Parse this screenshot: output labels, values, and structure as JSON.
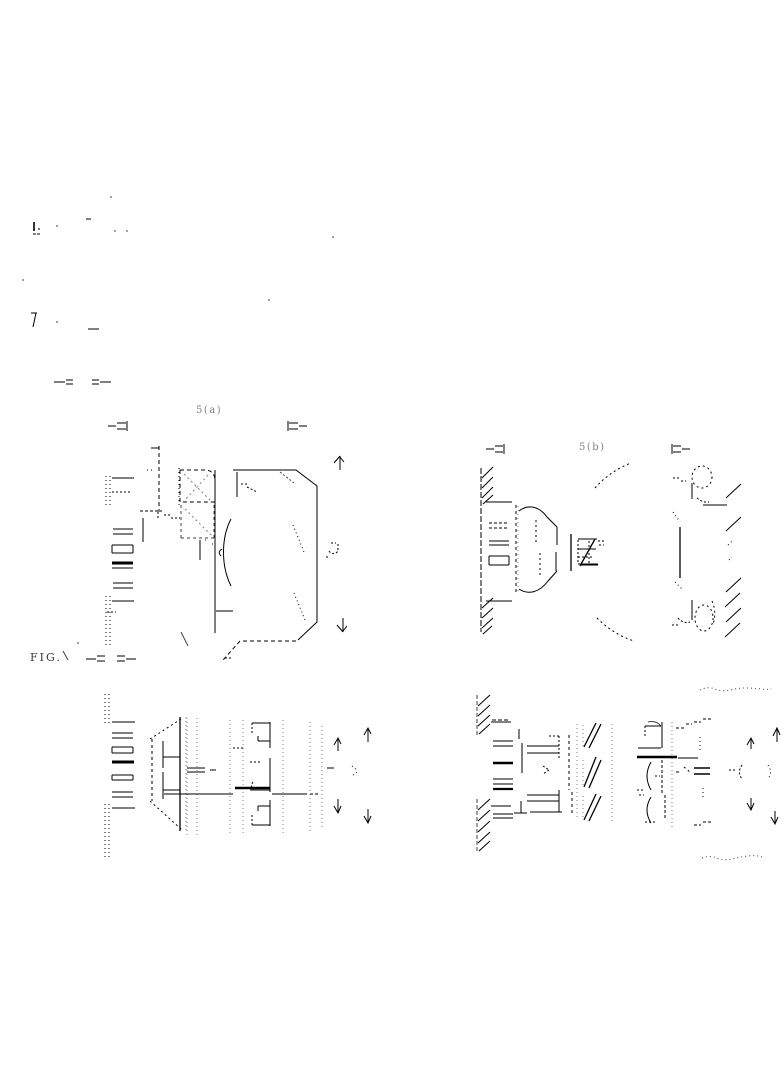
{
  "page": {
    "background_color": "#ffffff",
    "ink_color": "#000000"
  },
  "captions": {
    "figure_caption": "FIG.",
    "view_a_label": "5(a)",
    "view_b_label": "5(b)"
  }
}
